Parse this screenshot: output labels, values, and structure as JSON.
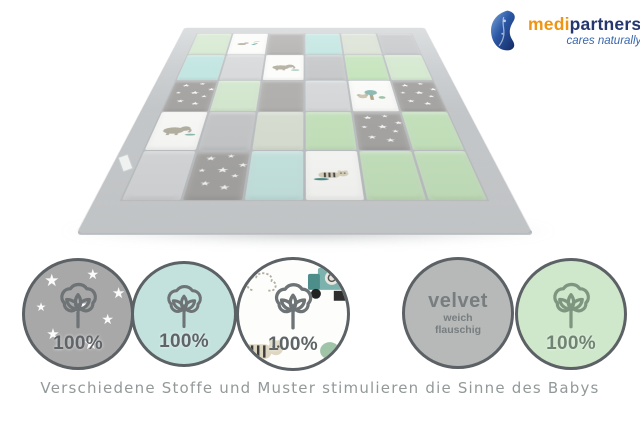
{
  "logo": {
    "brand_first": "medi",
    "brand_second": "partners",
    "tagline": "cares naturally",
    "colors": {
      "orange": "#ef9413",
      "navy": "#25376e",
      "blue": "#3866ac"
    }
  },
  "mat": {
    "description": "patchwork baby play mat in perspective with gray binding",
    "palette": {
      "mint": "#d6e9d1",
      "green": "#c7e5bf",
      "sage": "#dbe2d5",
      "aqua": "#c3e6e2",
      "aquadots": "#c9e8e4",
      "lightgray": "#d8dadc",
      "gray": "#c7c9cb",
      "graystars": "#a8a7a5",
      "graydots": "#b3b2b0",
      "print": "#fcfcfa",
      "binding": "#ccd0d2"
    },
    "grid": [
      [
        "mint",
        "print:birds",
        "graydots",
        "aqua",
        "sage",
        "gray"
      ],
      [
        "aqua",
        "lightgray",
        "print:elephant",
        "gray",
        "green",
        "mint"
      ],
      [
        "graystars",
        "mint",
        "graydots",
        "lightgray",
        "print:koala",
        "graystars"
      ],
      [
        "print:elephant",
        "gray",
        "sage",
        "green",
        "graystars",
        "green"
      ],
      [
        "lightgray",
        "graystars",
        "aquadots",
        "print:tiger",
        "green",
        "green"
      ]
    ]
  },
  "badges": [
    {
      "name": "cotton-gray-stars",
      "pattern": "stars",
      "bg": "#a8a8a8",
      "icon": "cotton",
      "icon_color": "#6e7376",
      "label": "100%"
    },
    {
      "name": "cotton-mint-dots",
      "pattern": "dots",
      "bg": "#c3e2de",
      "icon": "cotton",
      "icon_color": "#6e7376",
      "label": "100%"
    },
    {
      "name": "cotton-animal-print",
      "pattern": "print",
      "bg": "#fdfdfc",
      "icon": "cotton",
      "icon_color": "#6e7376",
      "label": "100%"
    },
    {
      "name": "velvet",
      "pattern": "solid",
      "bg": "#b6b9b7",
      "icon": null,
      "icon_color": null,
      "label": "velvet",
      "sublabels": [
        "weich",
        "flauschig"
      ]
    },
    {
      "name": "cotton-green-stripes",
      "pattern": "stripes",
      "bg": "#cfe7cb",
      "icon": "cotton",
      "icon_color": "#7e967f",
      "label": "100%"
    }
  ],
  "caption": "Verschiedene Stoffe und Muster stimulieren die Sinne des Babys"
}
